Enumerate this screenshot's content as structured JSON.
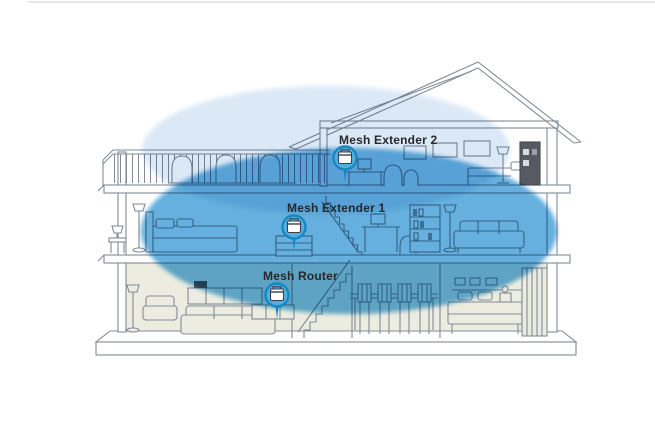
{
  "diagram": {
    "type": "mesh-wifi-home-coverage",
    "devices": [
      {
        "id": "mesh-extender-2",
        "label": "Mesh Extender 2",
        "floor": "top"
      },
      {
        "id": "mesh-extender-1",
        "label": "Mesh Extender 1",
        "floor": "middle"
      },
      {
        "id": "mesh-router",
        "label": "Mesh Router",
        "floor": "ground"
      }
    ],
    "colors": {
      "coverage_outer": "#dbe9f6",
      "coverage_inner": "#58a9db",
      "ground_floor_fill": "#ecede0",
      "line_art": "#828a98",
      "marker_fill": "#54aede",
      "marker_ring": "#1787c2",
      "label_text": "#26282b"
    }
  }
}
